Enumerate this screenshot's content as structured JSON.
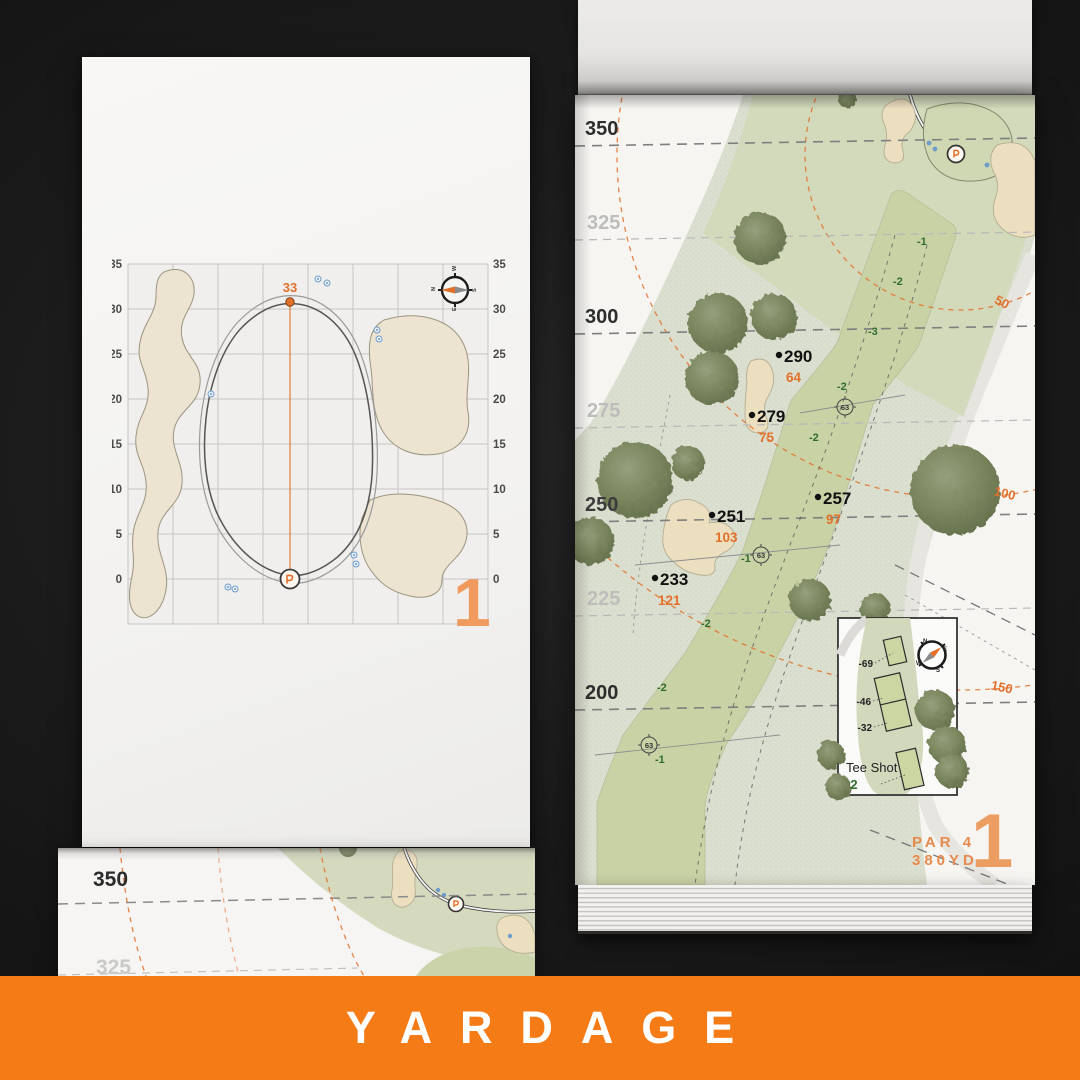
{
  "banner": {
    "title": "YARDAGE",
    "background_color": "#f57b17",
    "text_color": "#ffffff"
  },
  "compass_letters": {
    "n": "N",
    "e": "E",
    "s": "S",
    "w": "W"
  },
  "green_detail_page": {
    "hole_number": "1",
    "pin_depth": "33",
    "axis_ticks": [
      "35",
      "30",
      "25",
      "20",
      "15",
      "10",
      "5",
      "0"
    ]
  },
  "hole_map_page": {
    "hole_number": "1",
    "par_label": "PAR 4",
    "yardage_label": "380YD",
    "distance_labels": [
      "350",
      "325",
      "300",
      "275",
      "250",
      "225",
      "200"
    ],
    "arc_labels": [
      "50",
      "100",
      "150"
    ],
    "markers": [
      {
        "carry": "290",
        "to_green": "64"
      },
      {
        "carry": "279",
        "to_green": "75"
      },
      {
        "carry": "257",
        "to_green": "97"
      },
      {
        "carry": "251",
        "to_green": "103"
      },
      {
        "carry": "233",
        "to_green": "121"
      }
    ],
    "elevation_notes": [
      "-1",
      "-2",
      "-3",
      "-2",
      "-2",
      "-1",
      "-2",
      "-2",
      "-1"
    ],
    "sprinkler_head_yardages": [
      "63",
      "63",
      "63"
    ],
    "tee_inset": {
      "title": "Tee Shot",
      "elevation": "-2",
      "tee_offsets": [
        "-69",
        "-46",
        "-32"
      ]
    }
  },
  "next_page_fragment": {
    "distance_labels": [
      "350",
      "325"
    ]
  },
  "colors": {
    "accent_orange": "#e2702a",
    "soft_orange": "#f09a5e",
    "fairway_green": "#c8d2a5",
    "rough_green": "#dbdfcf",
    "tree_green": "#79855d",
    "bunker_sand": "#ecdfc0",
    "elevation_green": "#2f6b2f",
    "sprinkler_blue": "#6f9cc9"
  }
}
